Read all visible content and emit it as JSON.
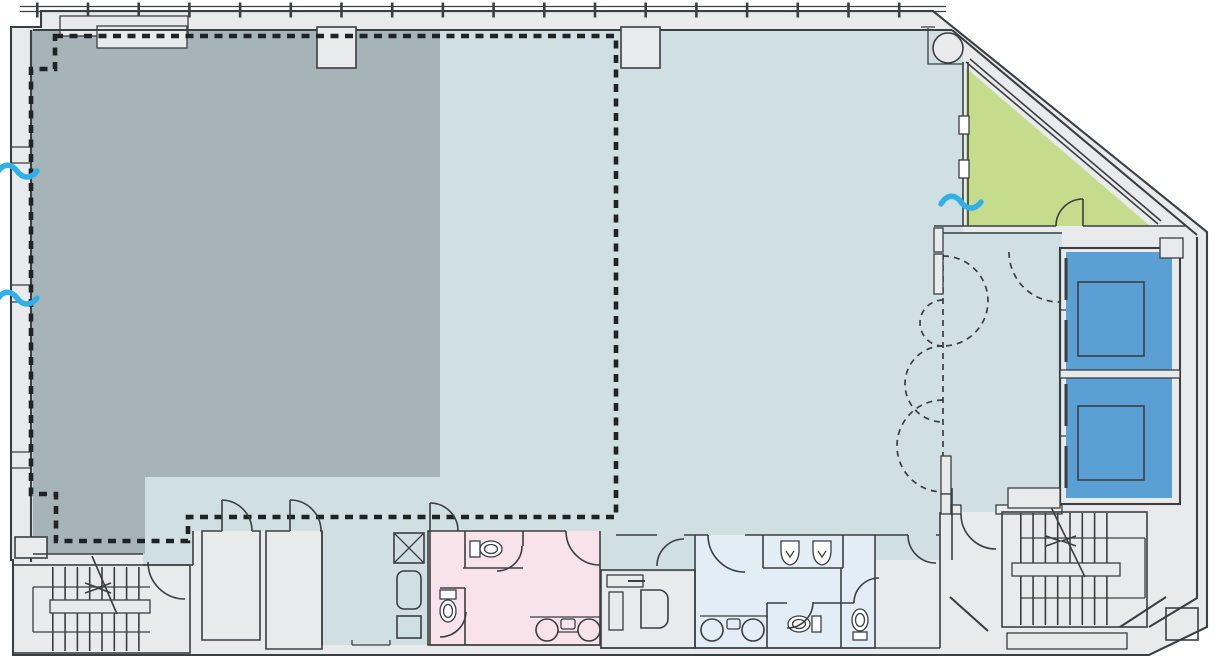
{
  "drawing": {
    "kind": "architectural floor plan",
    "colors": {
      "paper": "#ffffff",
      "wall_fill": "#e9eaec",
      "wall_line": "#3a3f42",
      "zone_main": "#cfdfe2",
      "zone_dark": "#a6b4b8",
      "zone_green": "#c5dc8d",
      "zone_elevator": "#5ba0d5",
      "zone_womens": "#f8e3eb",
      "zone_mens": "#e2edf5",
      "demise": "#1f2325",
      "break": "#2fb0e8"
    },
    "zones": [
      {
        "id": "zone-dark",
        "label": "shaded area (left)",
        "color": "#a6b4b8"
      },
      {
        "id": "zone-main",
        "label": "main open area",
        "color": "#cfdfe2"
      },
      {
        "id": "zone-green",
        "label": "corner room (north-east)",
        "color": "#c5dc8d"
      },
      {
        "id": "zone-elevator-lobby",
        "label": "elevator lobby",
        "color": "#cfdfe2"
      },
      {
        "id": "zone-elevators",
        "label": "elevator shafts",
        "color": "#5ba0d5"
      },
      {
        "id": "zone-womens-restroom",
        "label": "restroom (pink)",
        "color": "#f8e3eb"
      },
      {
        "id": "zone-mens-restroom",
        "label": "restroom (light blue)",
        "color": "#e2edf5"
      }
    ],
    "symbols": [
      "dashed-demise-line",
      "door-swing",
      "future-door-swing-dashed",
      "stair-run-with-direction-arrow",
      "break-line-wave",
      "duct-shaft-x",
      "toilet",
      "urinal",
      "wash-basin",
      "elevator-car",
      "round-column",
      "curtain-wall-mullions"
    ]
  }
}
